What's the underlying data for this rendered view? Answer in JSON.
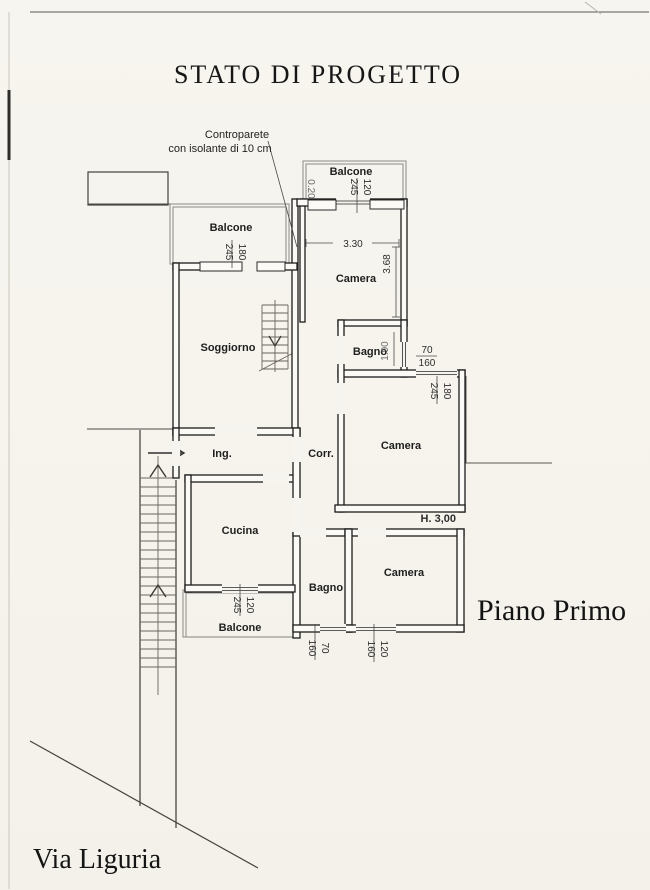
{
  "title": "STATO DI PROGETTO",
  "captions": {
    "floor": "Piano Primo",
    "street": "Via Liguria"
  },
  "annotation": {
    "line1": "Controparete",
    "line2": "con isolante di 10 cm"
  },
  "rooms": {
    "balcone_top": "Balcone",
    "balcone_left": "Balcone",
    "balcone_bottom": "Balcone",
    "camera_top": "Camera",
    "camera_mid": "Camera",
    "camera_bottom": "Camera",
    "bagno_mid": "Bagno",
    "bagno_bottom": "Bagno",
    "soggiorno": "Soggiorno",
    "ingresso": "Ing.",
    "corridoio": "Corr.",
    "cucina": "Cucina"
  },
  "dimensions": {
    "camera_top_width": "3.30",
    "camera_top_depth": "3.68",
    "bagno_mid_depth": "1.90",
    "wall_thickness": "0.20",
    "room_height": "H. 3,00",
    "win_balcone_top": {
      "w": "120",
      "h": "245"
    },
    "win_balcone_left": {
      "w": "180",
      "h": "245"
    },
    "win_camera_mid": {
      "w": "180",
      "h": "245"
    },
    "win_bagno_mid": {
      "w": "70",
      "h": "160"
    },
    "win_cucina": {
      "w": "120",
      "h": "245"
    },
    "win_bagno_bottom": {
      "w": "70",
      "h": "160"
    },
    "win_camera_bottom": {
      "w": "120",
      "h": "160"
    }
  }
}
